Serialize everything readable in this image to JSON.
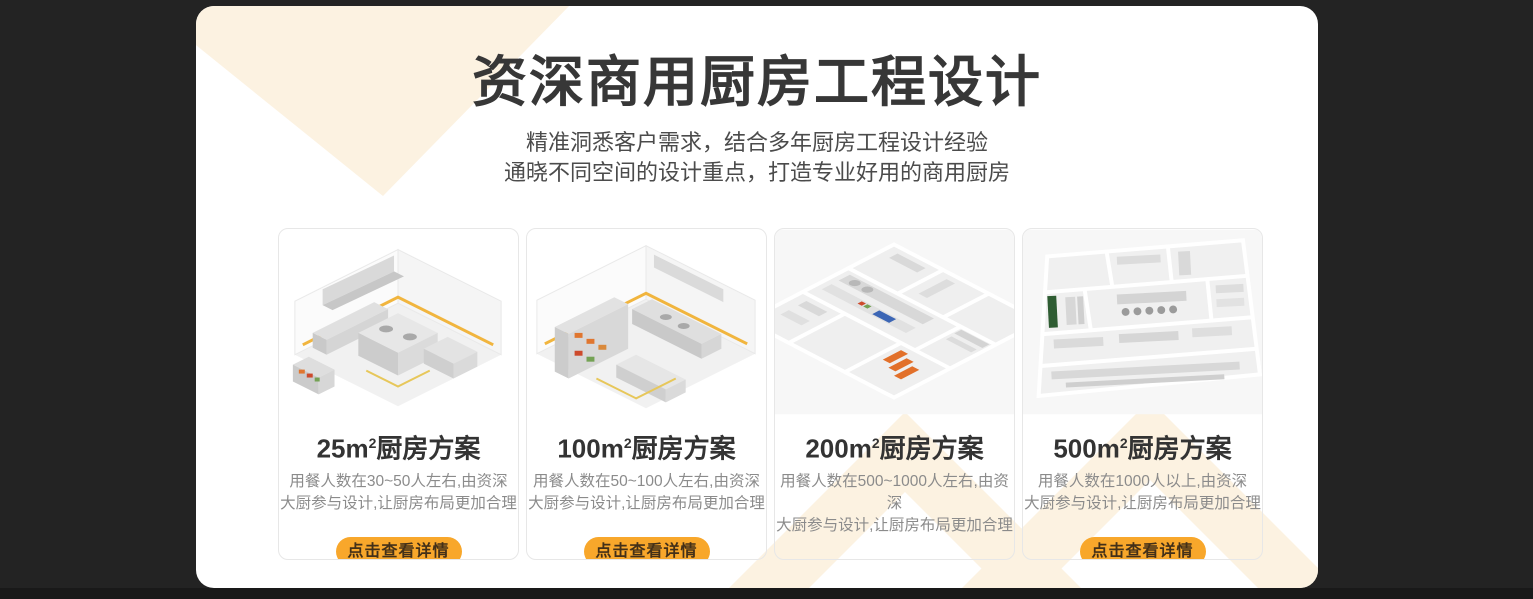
{
  "colors": {
    "page_background": "#232323",
    "bottom_strip": "#191919",
    "panel_background": "#ffffff",
    "pattern_cream": "#fcf2e1",
    "title_text": "#373737",
    "subtitle_text": "#4b4b4b",
    "card_border": "#e7e7e7",
    "card_title_text": "#333333",
    "card_desc_text": "#8b8b8b",
    "button_background": "#f8a72b",
    "button_text": "#433018",
    "caution_stripe_yellow": "#f1b53e",
    "equipment_accent_orange": "#e2702a"
  },
  "header": {
    "title": "资深商用厨房工程设计",
    "subtitle_lines": [
      "精准洞悉客户需求，结合多年厨房工程设计经验",
      "通晓不同空间的设计重点，打造专业好用的商用厨房"
    ]
  },
  "cards": [
    {
      "title": {
        "area": "25m",
        "sup": "2",
        "rest": "厨房方案"
      },
      "desc_line1": "用餐人数在30~50人左右,由资深",
      "desc_line2": "大厨参与设计,让厨房布局更加合理",
      "button_label": "点击查看详情",
      "image": "isometric-kitchen-render"
    },
    {
      "title": {
        "area": "100m",
        "sup": "2",
        "rest": "厨房方案"
      },
      "desc_line1": "用餐人数在50~100人左右,由资深",
      "desc_line2": "大厨参与设计,让厨房布局更加合理",
      "button_label": "点击查看详情",
      "image": "isometric-kitchen-render"
    },
    {
      "title": {
        "area": "200m",
        "sup": "2",
        "rest": "厨房方案"
      },
      "desc_line1": "用餐人数在500~1000人左右,由资深",
      "desc_line2": "大厨参与设计,让厨房布局更加合理",
      "button_label": "点击查看详情",
      "image": "isometric-kitchen-floorplan-render"
    },
    {
      "title": {
        "area": "500m",
        "sup": "2",
        "rest": "厨房方案"
      },
      "desc_line1": "用餐人数在1000人以上,由资深",
      "desc_line2": "大厨参与设计,让厨房布局更加合理",
      "button_label": "点击查看详情",
      "image": "isometric-kitchen-floorplan-render"
    }
  ]
}
